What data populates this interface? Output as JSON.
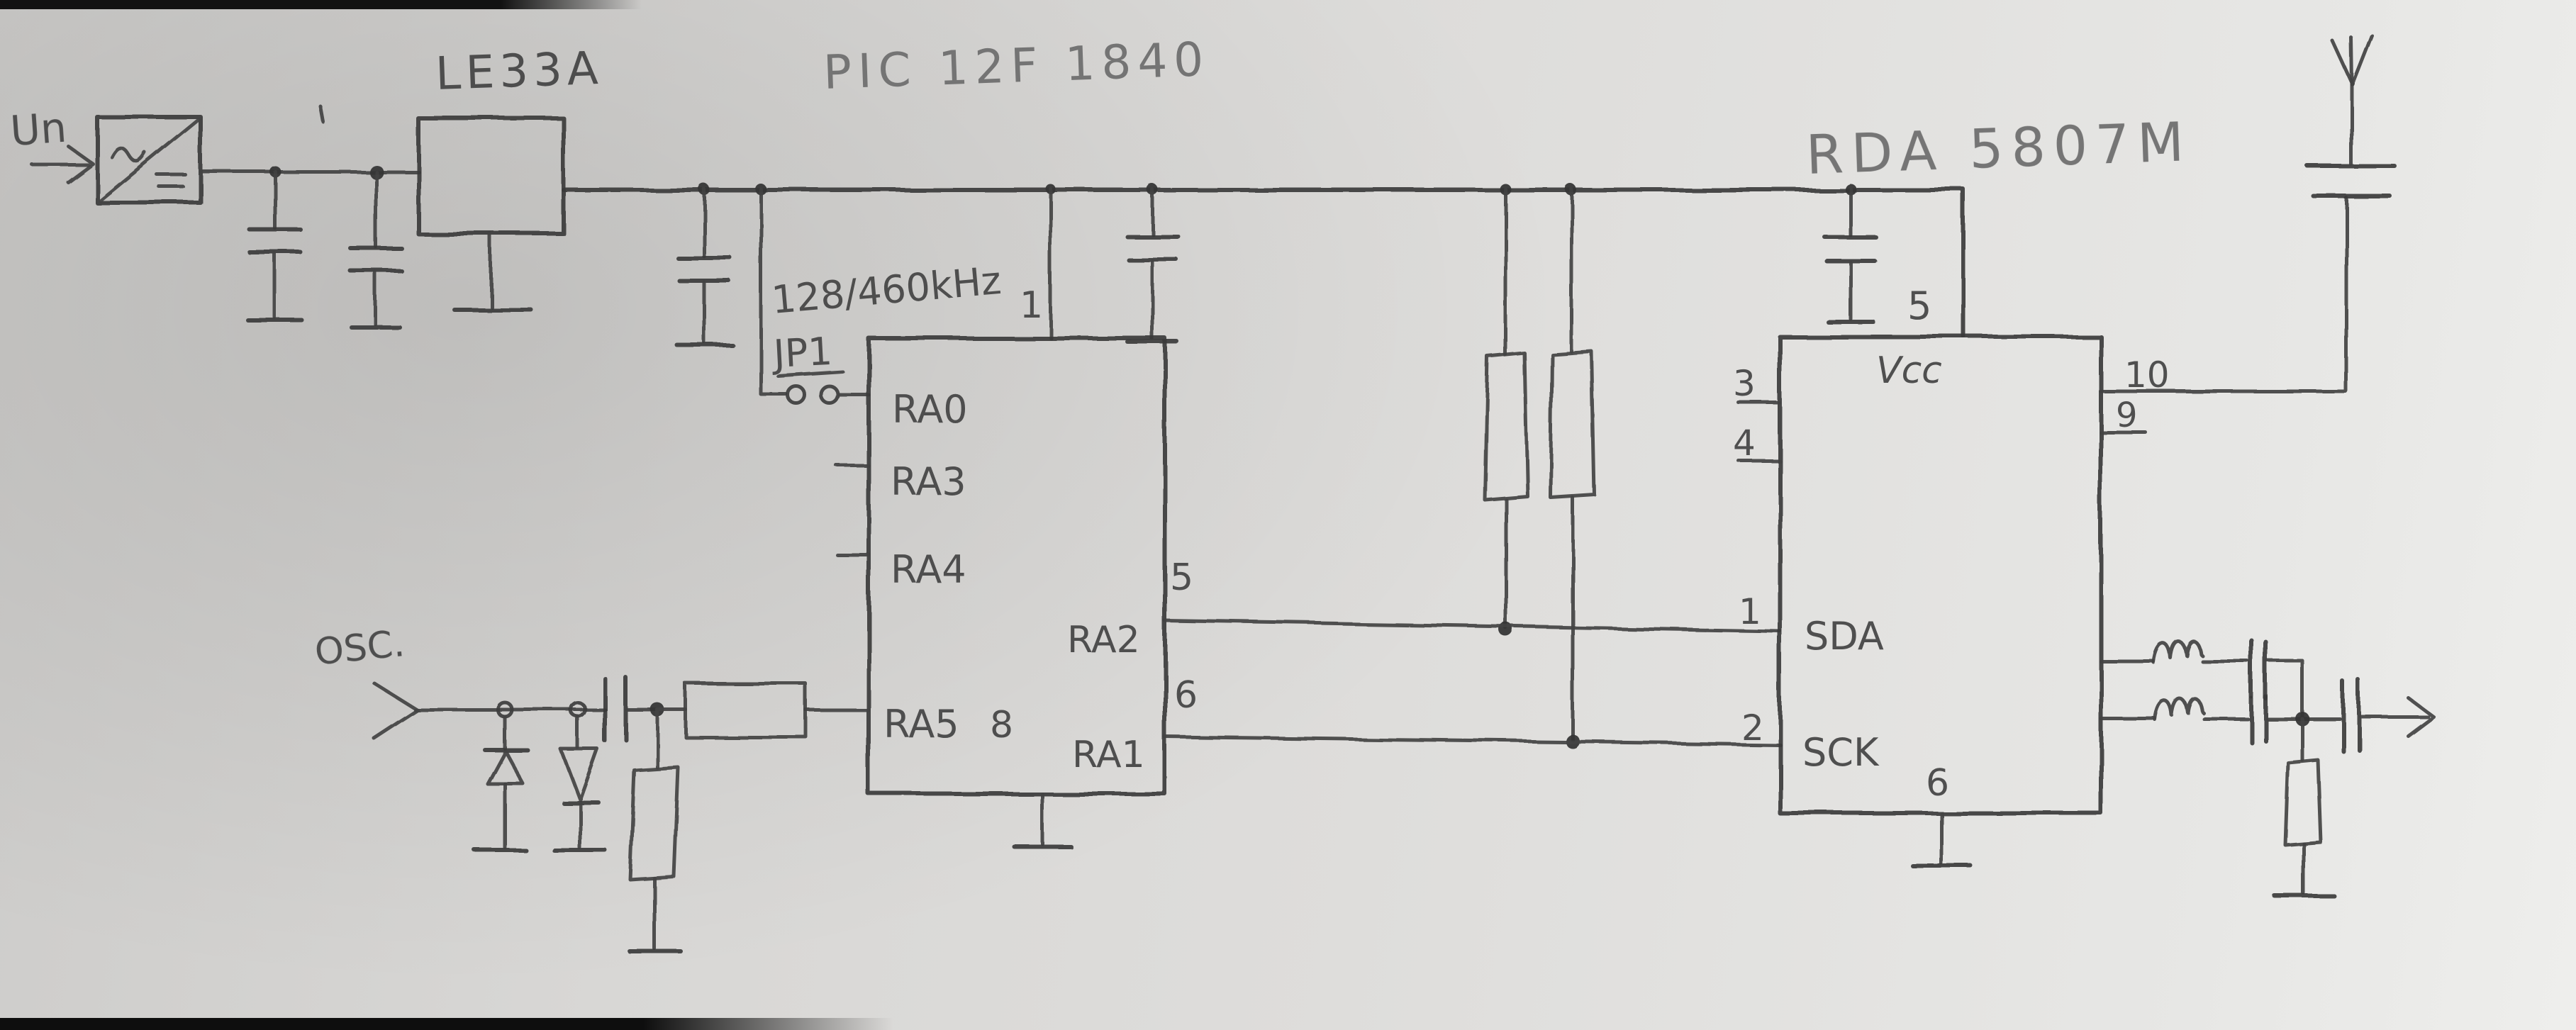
{
  "schematic": {
    "power": {
      "input_label": "Un",
      "regulator_label": "LE33A"
    },
    "osc_label": "OSC.",
    "mcu": {
      "title": "PIC 12F 1840",
      "freq_note": "128/460kHz",
      "jumper_label": "JP1",
      "top_pin": "1",
      "bottom_pin": "8",
      "left_pins": [
        "RA0",
        "RA3",
        "RA4",
        "RA5"
      ],
      "right_pins": [
        {
          "number": "5",
          "name": "RA2"
        },
        {
          "number": "6",
          "name": "RA1"
        }
      ]
    },
    "radio": {
      "title": "RDA 5807M",
      "top_pin": {
        "number": "5",
        "name": "Vcc"
      },
      "bottom_pin": "6",
      "left_pins": [
        {
          "number": "3",
          "name": ""
        },
        {
          "number": "4",
          "name": ""
        },
        {
          "number": "1",
          "name": "SDA"
        },
        {
          "number": "2",
          "name": "SCK"
        }
      ],
      "right_pins": [
        {
          "number": "10"
        },
        {
          "number": "9"
        }
      ]
    }
  }
}
